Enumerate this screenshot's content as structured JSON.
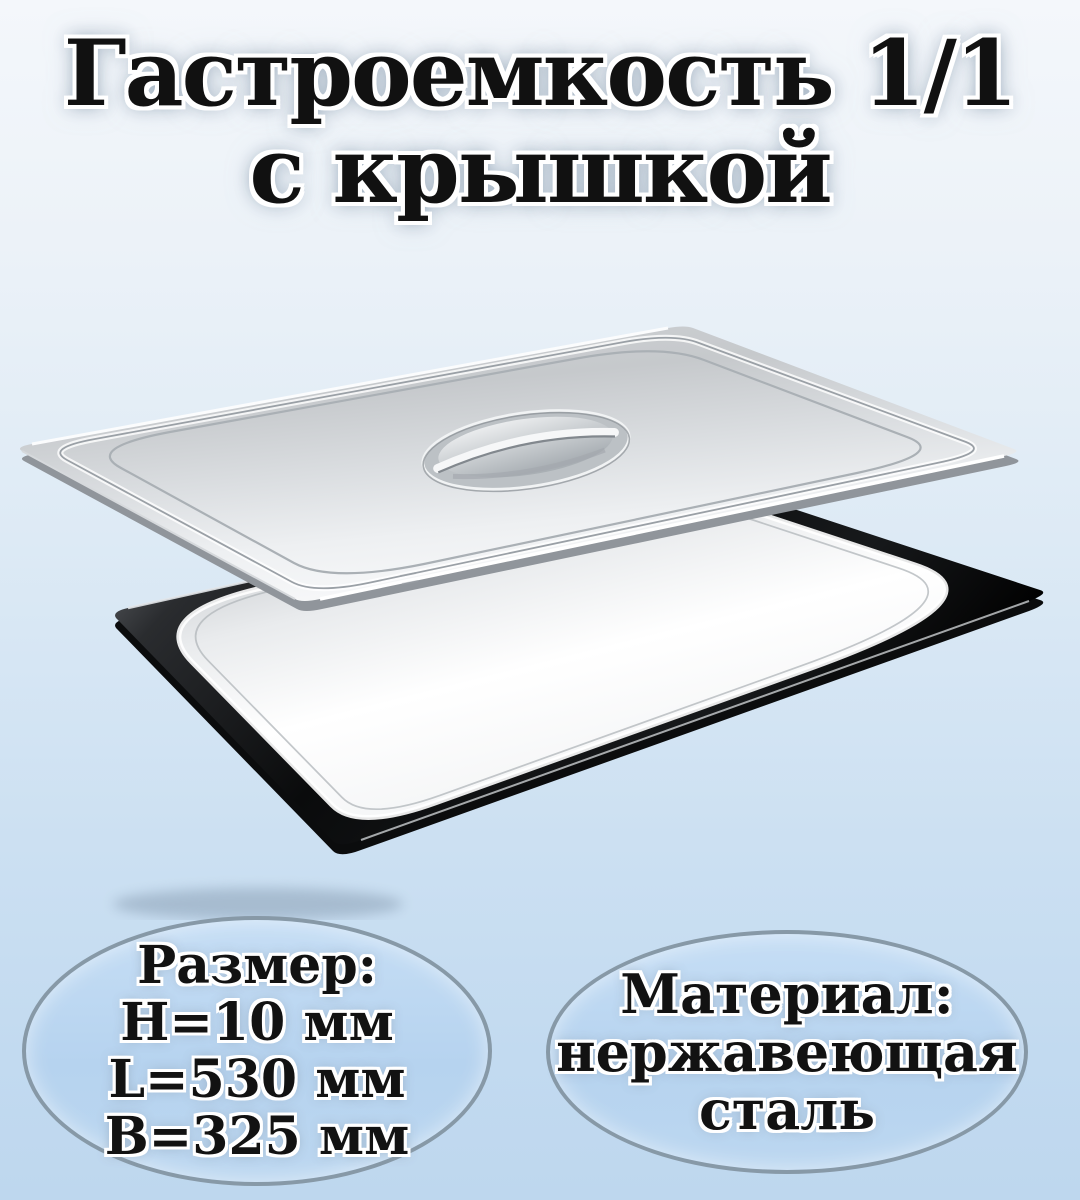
{
  "title": {
    "line1": "Гастроемкость 1/1",
    "line2": "с крышкой"
  },
  "size_badge": {
    "heading": "Размер:",
    "line1": "H=10 мм",
    "line2": "L=530 мм",
    "line3": "B=325 мм"
  },
  "material_badge": {
    "heading": "Материал:",
    "line1": "нержавеющая",
    "line2": "сталь"
  },
  "colors": {
    "background_top": "#f4f7fb",
    "background_bottom": "#bed7ee",
    "badge_fill": "#b9d4ef",
    "badge_border": "#8799a7",
    "text": "#121212",
    "steel_light": "#f2f4f5",
    "steel_mid": "#c9ccd0",
    "pan_rim_dark": "#0a0b0c"
  }
}
